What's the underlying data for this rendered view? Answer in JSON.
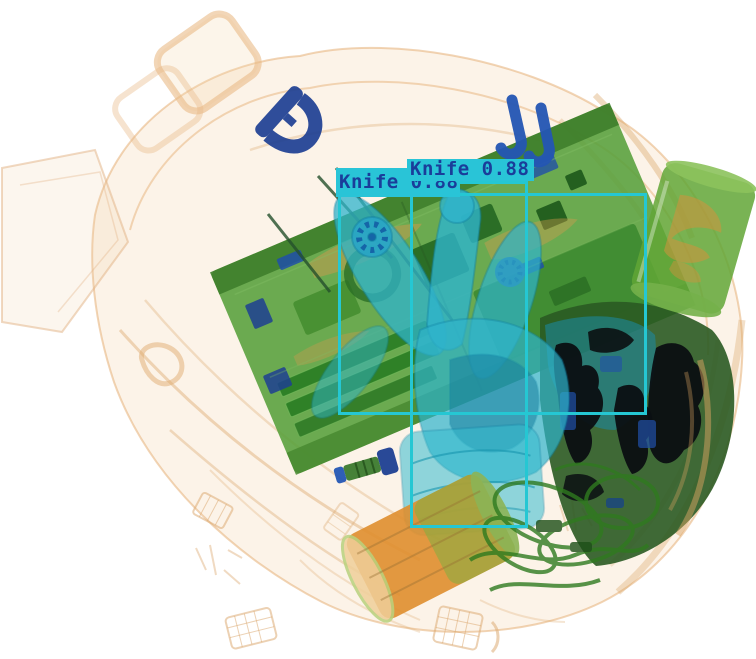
{
  "scene": {
    "description": "X-ray baggage security scan with knife detection overlay",
    "background_color": "#ffffff",
    "objects": [
      "translucent orange travel bag with handles and pockets",
      "green laptop motherboard with RAM bars and chips",
      "cyan rubber glove with fanned fingers",
      "navy D-ring carabiner",
      "two royal-blue hook clips",
      "green beverage can with orange contents",
      "orange bottle cylinder with green rim",
      "small bolt with blue head",
      "dense black metal mass",
      "dark green cable tangle",
      "faint orange mesh debris patches"
    ]
  },
  "style": {
    "colors": {
      "bg": "#ffffff",
      "box-cyan": "#25c7d3",
      "label-bg": "#29c4d7",
      "label-text": "#1a3d9a",
      "bag-orange": "#e6b07a",
      "board-green": "#569f3a",
      "glove-cyan": "#2fb4cc",
      "metal-navy": "#1d3f92",
      "hook-blue": "#2456b4",
      "dense-black": "#0b0f12",
      "cylinder-orange": "#df8e2e",
      "can-green": "#61a636",
      "wire-green": "#2f7a1f"
    }
  },
  "detections": [
    {
      "label": "Knife",
      "confidence": 0.88,
      "display_text": "Knife 0.88",
      "box": {
        "x": 338,
        "y": 193,
        "w": 309,
        "h": 222
      },
      "label_rect": {
        "x": 336,
        "y": 168,
        "w": 121,
        "h": 25
      },
      "note": "label partially occluded by second label"
    },
    {
      "label": "Knife",
      "confidence": 0.88,
      "display_text": "Knife 0.88",
      "box": {
        "x": 410,
        "y": 181,
        "w": 118,
        "h": 347
      },
      "label_rect": {
        "x": 407,
        "y": 159,
        "w": 124,
        "h": 22
      }
    }
  ]
}
